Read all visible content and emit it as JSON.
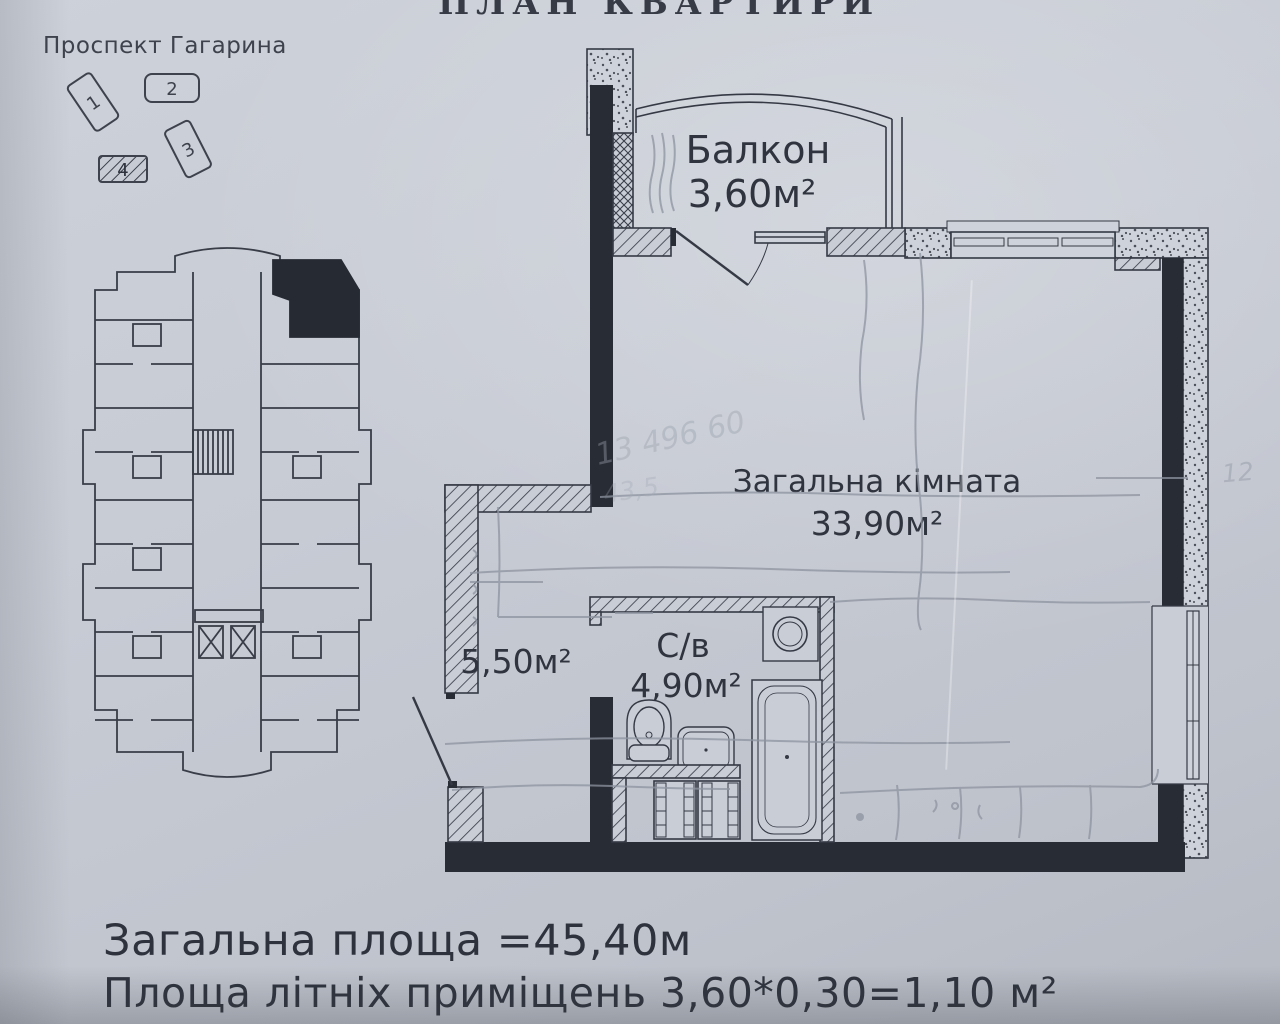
{
  "document": {
    "title": "ПЛАН КВАРТИРИ",
    "site_plan": {
      "street_label": "Проспект Гагарина",
      "buildings": [
        {
          "number": "1",
          "highlighted": false
        },
        {
          "number": "2",
          "highlighted": false
        },
        {
          "number": "3",
          "highlighted": false
        },
        {
          "number": "4",
          "highlighted": true
        }
      ]
    },
    "apartment_plan": {
      "rooms": {
        "balcony": {
          "label": "Балкон",
          "area": "3,60м²"
        },
        "living": {
          "label": "Загальна кімната",
          "area": "33,90м²"
        },
        "hall": {
          "area": "5,50м²"
        },
        "bathroom": {
          "label": "С/в",
          "area": "4,90м²"
        }
      }
    },
    "pencil_notes": {
      "note1": "13 496 60",
      "note2": "43,5",
      "note3": "12"
    },
    "summary": {
      "total_area": "Загальна площа =45,40м",
      "summer_area": "Площа літніх приміщень 3,60*0,30=1,10 м²"
    },
    "colors": {
      "paper": "#c7cbd4",
      "ink": "#343944",
      "wall_fill": "#282c34",
      "pencil": "#8e94a0"
    }
  }
}
